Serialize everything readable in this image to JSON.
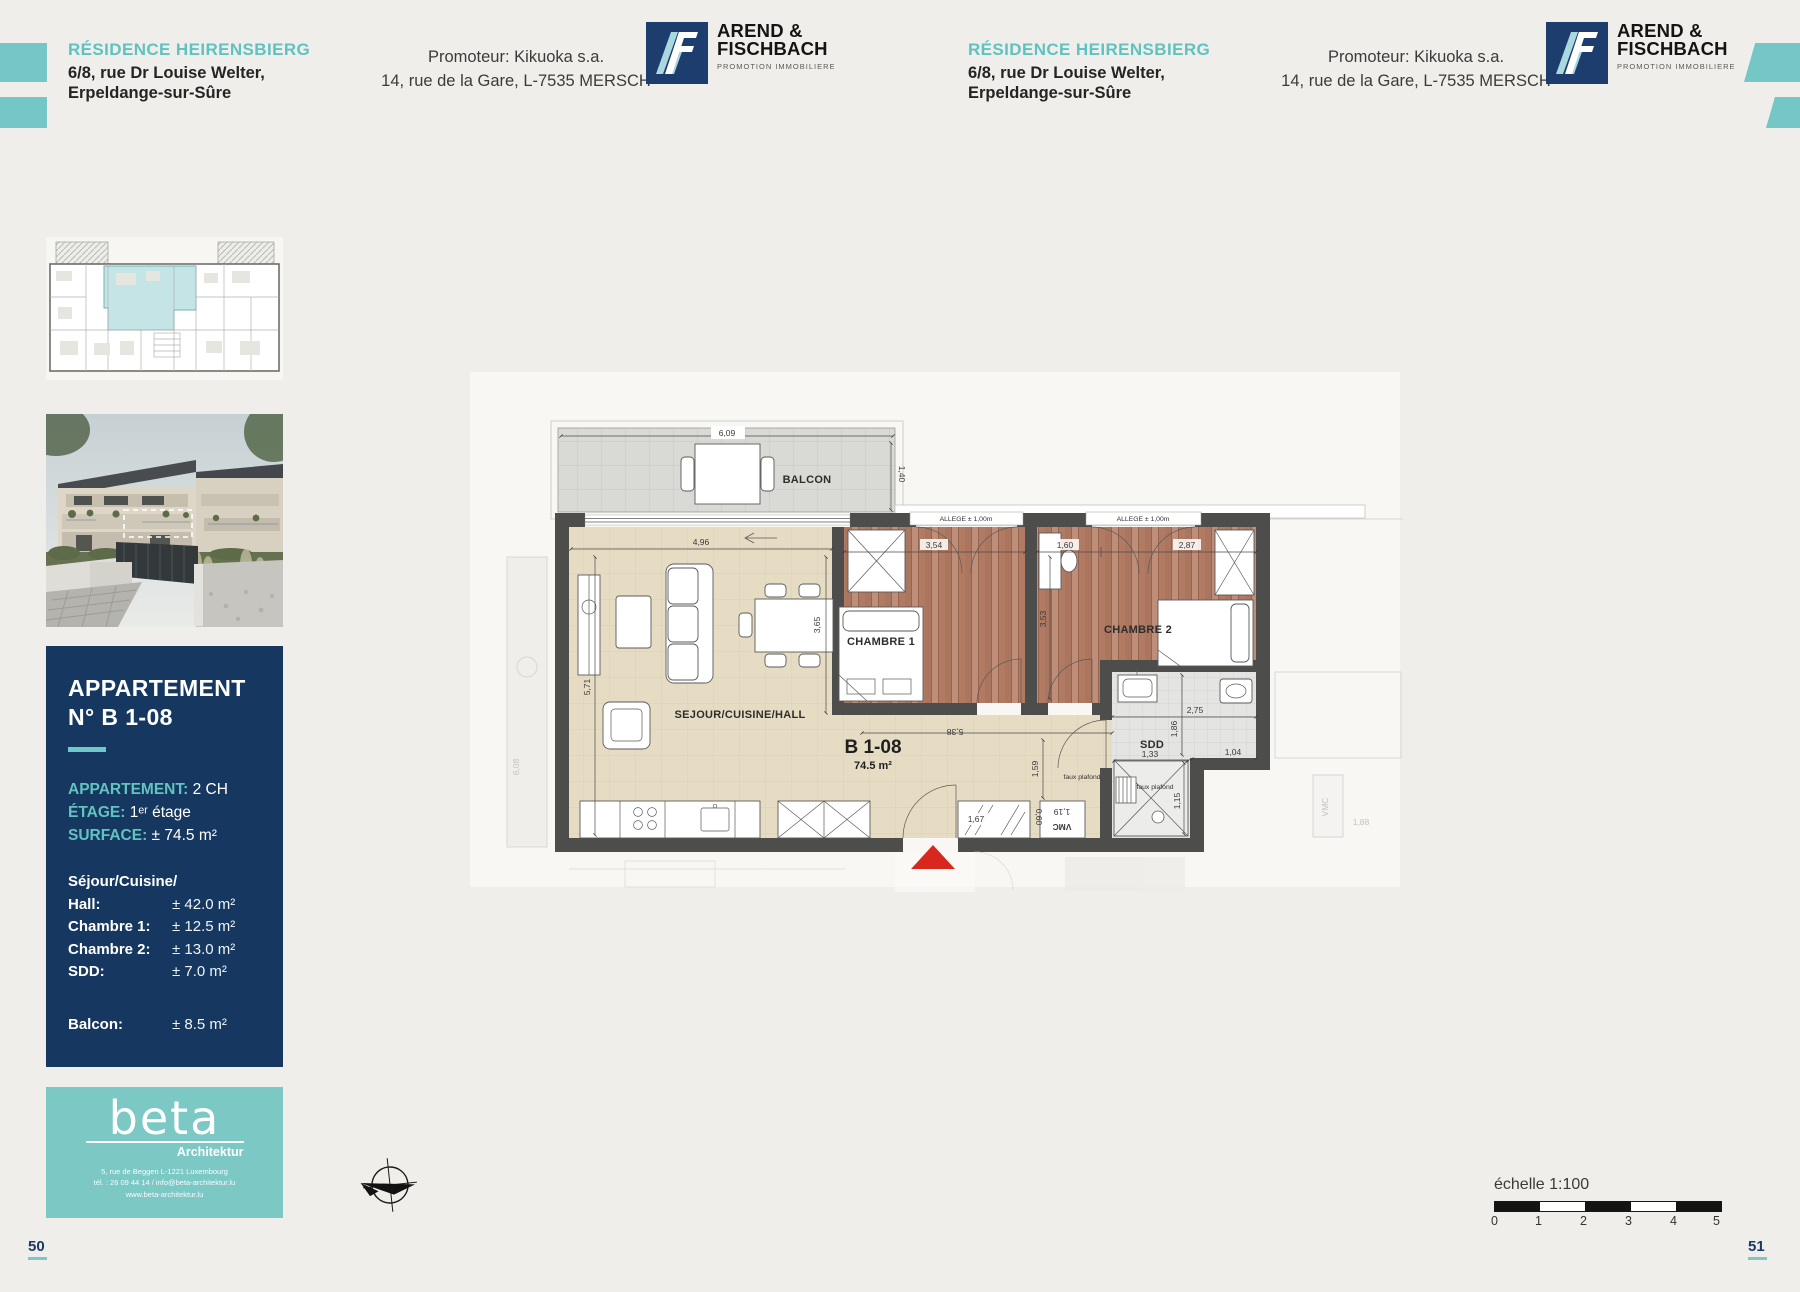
{
  "colors": {
    "accent_teal": "#74c7c4",
    "card_navy": "#16375f",
    "logo_navy": "#1e3d6f",
    "entrance_red": "#d8281e"
  },
  "header": {
    "title": "RÉSIDENCE HEIRENSBIERG",
    "address1": "6/8, rue Dr Louise Welter,",
    "address2": "Erpeldange-sur-Sûre"
  },
  "promoter": {
    "line1": "Promoteur: Kikuoka s.a.",
    "line2": "14, rue de la Gare, L-7535 MERSCH"
  },
  "developer_logo": {
    "name1": "AREND &",
    "name2": "FISCHBACH",
    "tagline": "PROMOTION IMMOBILIERE"
  },
  "sidebar": {
    "apartment_card": {
      "title1": "APPARTEMENT",
      "title2": "N° B 1-08",
      "specs": [
        {
          "label": "APPARTEMENT:",
          "value": "2 CH"
        },
        {
          "label": "ÉTAGE:",
          "value": "1ᵉʳ étage"
        },
        {
          "label": "SURFACE:",
          "value": "± 74.5 m²"
        }
      ],
      "rooms_intro": "Séjour/Cuisine/",
      "rooms": [
        {
          "label": "Hall:",
          "value": "± 42.0 m²"
        },
        {
          "label": "Chambre 1:",
          "value": "± 12.5 m²"
        },
        {
          "label": "Chambre 2:",
          "value": "± 13.0 m²"
        },
        {
          "label": "SDD:",
          "value": "± 7.0 m²"
        }
      ],
      "balcony": {
        "label": "Balcon:",
        "value": "± 8.5 m²"
      }
    },
    "architect_card": {
      "logo": "beta",
      "subtitle": "Architektur",
      "address": "5, rue de Beggen L-1221 Luxembourg",
      "contact": "tél. : 26 09 44 14 / info@beta-architektur.lu",
      "website": "www.beta-architektur.lu"
    }
  },
  "plan": {
    "unit": "B 1-08",
    "area": "74.5 m²",
    "rooms": {
      "balcony": "BALCON",
      "living": "SEJOUR/CUISINE/HALL",
      "bedroom1": "CHAMBRE 1",
      "bedroom2": "CHAMBRE 2",
      "bathroom": "SDD"
    },
    "annotations": {
      "allege": "ALLEGE ± 1,00m",
      "faux_plafond": "faux plafond",
      "vmc": "VMC"
    },
    "dims": {
      "balcony_w": "6,09",
      "balcony_d": "1,40",
      "living_w": "4,96",
      "bedroom1_w": "3,54",
      "bedroom2_a": "1,60",
      "bedroom2_b": "2,87",
      "living_h": "3,65",
      "bedroom2_h": "3,53",
      "living_left": "5,71",
      "hall_w": "5,38",
      "hall_h": "1,59",
      "closet_w": "1,67",
      "closet_d": "0,60",
      "duct_w": "1,19",
      "bath_w": "2,75",
      "bath_h": "1,86",
      "shower_w": "1,33",
      "bath_b": "1,04",
      "shower_h": "1,15",
      "ghost_left": "6,08",
      "ghost_right": "1,88"
    }
  },
  "footer": {
    "scale_label": "échelle 1:100",
    "scale_ticks": [
      "0",
      "1",
      "2",
      "3",
      "4",
      "5"
    ],
    "page_left": "50",
    "page_right": "51"
  }
}
